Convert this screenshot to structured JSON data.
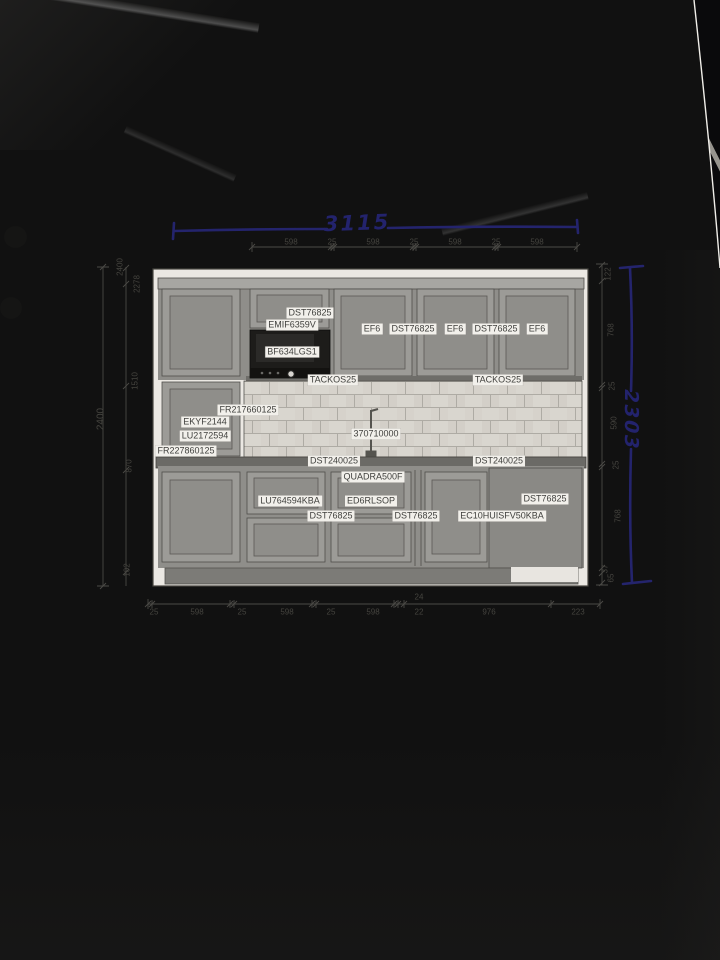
{
  "photo": {
    "paper_color": "#e7e4df",
    "ink_blue": "#24246d",
    "table_color": "#0a0a0c"
  },
  "handwritten": {
    "top_width": "3115",
    "right_height": "2303"
  },
  "printed_dimensions": {
    "top_chain": [
      [
        "598",
        291,
        242
      ],
      [
        "25",
        332,
        242
      ],
      [
        "598",
        373,
        242
      ],
      [
        "25",
        414,
        242
      ],
      [
        "598",
        455,
        242
      ],
      [
        "25",
        496,
        242
      ],
      [
        "598",
        537,
        242
      ]
    ],
    "bottom_chain": [
      [
        "25",
        154,
        612
      ],
      [
        "598",
        197,
        612
      ],
      [
        "25",
        242,
        612
      ],
      [
        "598",
        287,
        612
      ],
      [
        "25",
        331,
        612
      ],
      [
        "598",
        373,
        612
      ],
      [
        "24",
        419,
        597
      ],
      [
        "22",
        419,
        612
      ],
      [
        "976",
        489,
        612
      ],
      [
        "223",
        578,
        612
      ]
    ],
    "left_column": [
      [
        "2400",
        120,
        267
      ],
      [
        "2278",
        137,
        284
      ],
      [
        "1510",
        135,
        381
      ],
      [
        "870",
        129,
        466
      ],
      [
        "102",
        127,
        570
      ],
      [
        "2400",
        101,
        419,
        10
      ]
    ],
    "right_column": [
      [
        "122",
        608,
        274
      ],
      [
        "768",
        611,
        330
      ],
      [
        "25",
        612,
        386
      ],
      [
        "590",
        614,
        423
      ],
      [
        "25",
        616,
        465
      ],
      [
        "768",
        618,
        516
      ],
      [
        "37",
        605,
        569
      ],
      [
        "65",
        611,
        578
      ]
    ]
  },
  "product_labels": [
    [
      "DST76825",
      310,
      313
    ],
    [
      "EMIF6359V",
      292,
      325
    ],
    [
      "BF634LGS1",
      292,
      352
    ],
    [
      "EF6",
      372,
      329
    ],
    [
      "DST76825",
      413,
      329
    ],
    [
      "EF6",
      455,
      329
    ],
    [
      "DST76825",
      496,
      329
    ],
    [
      "EF6",
      537,
      329
    ],
    [
      "TACKOS25",
      333,
      380
    ],
    [
      "TACKOS25",
      498,
      380
    ],
    [
      "FR217660125",
      248,
      410
    ],
    [
      "EKYF2144",
      205,
      422
    ],
    [
      "LU2172594",
      205,
      436
    ],
    [
      "FR227860125",
      186,
      451
    ],
    [
      "370710000",
      376,
      434
    ],
    [
      "DST240025",
      334,
      461
    ],
    [
      "DST240025",
      499,
      461
    ],
    [
      "QUADRA500F",
      373,
      477
    ],
    [
      "LU764594KBA",
      290,
      501
    ],
    [
      "ED6RLSOP",
      371,
      501
    ],
    [
      "DST76825",
      545,
      499
    ],
    [
      "DST76825",
      331,
      516
    ],
    [
      "DST76825",
      416,
      516
    ],
    [
      "EC10HUISFV50KBA",
      502,
      516
    ]
  ]
}
